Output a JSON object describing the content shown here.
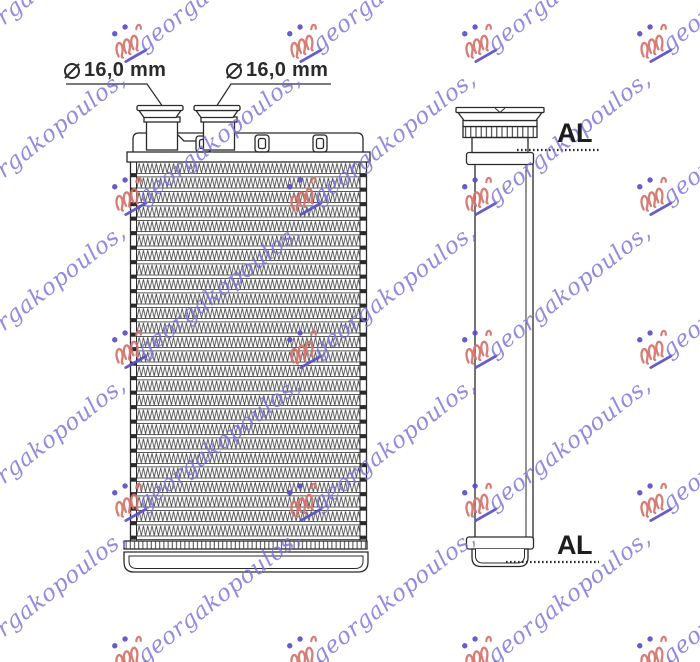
{
  "drawing": {
    "kind": "technical-part-drawing",
    "part": "heater radiator core, front and side view",
    "line_color": "#2a2a2a",
    "fin_color": "#4a4a4a",
    "background": "#ffffff"
  },
  "labels": {
    "diameter_1": {
      "symbol": "⌀",
      "text": "16,0 mm"
    },
    "diameter_2": {
      "symbol": "⌀",
      "text": "16,0 mm"
    },
    "material_top": "AL",
    "material_bottom": "AL"
  },
  "watermark": {
    "text": "georgakopoulos,",
    "text_color": "#7b72d8",
    "logo_red": "#d4736b",
    "logo_blue": "#5a50c8",
    "grid": {
      "cols": [
        -65,
        110,
        285,
        460,
        635
      ],
      "rows": [
        22,
        175,
        328,
        481,
        634
      ]
    }
  }
}
